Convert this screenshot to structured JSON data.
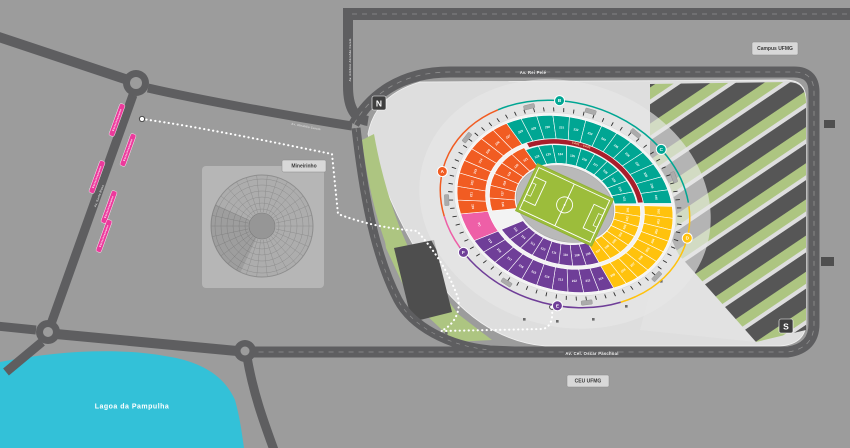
{
  "colors": {
    "background": "#9C9C9C",
    "road": "#5E5E60",
    "road_dash": "#8F8F8F",
    "plaza": "#DEDEDE",
    "esplanade": "#E6E6E6",
    "lake": "#33C1D8",
    "lawn": "#ADC581",
    "dark_block": "#4E4E4E",
    "stripe_dark": "#565656",
    "route_pink": "#EC3B9C",
    "path_white": "#FFFFFF",
    "sector_orange": "#F15C22",
    "sector_teal": "#00A693",
    "sector_yellow": "#FFC20D",
    "sector_purple": "#6F3E98",
    "sector_pink": "#EE5FA7",
    "camarote_red": "#A81E2B",
    "pitch": "#9CBD3B",
    "stadium_ring": "#B9B9B9",
    "marker_dark": "#3F3F3F"
  },
  "labels": {
    "lake": "Lagoa da Pampulha",
    "road_rei_pele": "Av. Rei Pelé",
    "road_oscar_paschoal": "Av. Cel. Oscar Paschoal",
    "road_abrahao_caram": "Av. Antônio Abrahão Caram",
    "road_abrahao_caram_short": "Av. Abrahão Caram",
    "road_santa_rosa": "Av. Santa Rosa",
    "badge_campus": "Campus UFMG",
    "badge_ceu": "CEU UFMG",
    "badge_mineirinho": "Mineirinho",
    "marker_north": "N",
    "marker_south": "S",
    "route_segment": "Estacionamento",
    "camarotes": "CA01 - CA43"
  },
  "stadium": {
    "gates": [
      {
        "letter": "A",
        "angle": 176,
        "color_key": "sector_orange"
      },
      {
        "letter": "B",
        "angle": 253,
        "color_key": "sector_teal"
      },
      {
        "letter": "C",
        "angle": 306,
        "color_key": "sector_teal"
      },
      {
        "letter": "D",
        "angle": 357,
        "color_key": "sector_yellow"
      },
      {
        "letter": "E",
        "angle": 79,
        "color_key": "sector_purple"
      },
      {
        "letter": "F",
        "angle": 130,
        "color_key": "sector_purple"
      }
    ],
    "sectors": [
      {
        "name": "yellow",
        "color_key": "sector_yellow",
        "start": -21,
        "end": 49,
        "upper": [
          "201",
          "202",
          "203",
          "204",
          "205",
          "206",
          "207",
          "208",
          "209"
        ],
        "lower": [
          "101",
          "102",
          "103",
          "104",
          "105",
          "106",
          "107"
        ]
      },
      {
        "name": "purple",
        "color_key": "sector_purple",
        "start": 49,
        "end": 133,
        "upper": [
          "210",
          "211",
          "212",
          "213",
          "214",
          "215",
          "216",
          "217",
          "218",
          "219"
        ],
        "lower": [
          "108",
          "109",
          "110",
          "111",
          "112",
          "113",
          "114",
          "115"
        ]
      },
      {
        "name": "pink",
        "color_key": "sector_pink",
        "start": 133,
        "end": 151,
        "upper": [
          "PC"
        ],
        "lower": []
      },
      {
        "name": "orange",
        "color_key": "sector_orange",
        "start": 151,
        "end": 223,
        "upper": [
          "220",
          "221",
          "222",
          "223",
          "224",
          "225",
          "226",
          "227"
        ],
        "lower": [
          "116",
          "117",
          "118",
          "119",
          "120",
          "121"
        ]
      },
      {
        "name": "teal",
        "color_key": "sector_teal",
        "start": 223,
        "end": 337,
        "upper": [
          "228",
          "229",
          "230",
          "231",
          "232",
          "233",
          "234",
          "235",
          "236",
          "237",
          "238",
          "239",
          "240"
        ],
        "lower": [
          "122",
          "123",
          "124",
          "125",
          "126",
          "127",
          "128",
          "129",
          "130",
          "131"
        ]
      }
    ],
    "camarote_band": {
      "start": 227,
      "end": 336
    }
  },
  "route_segments": [
    {
      "x": 117,
      "y": 120
    },
    {
      "x": 128,
      "y": 150
    },
    {
      "x": 97,
      "y": 177
    },
    {
      "x": 109,
      "y": 207
    },
    {
      "x": 104,
      "y": 236
    }
  ]
}
